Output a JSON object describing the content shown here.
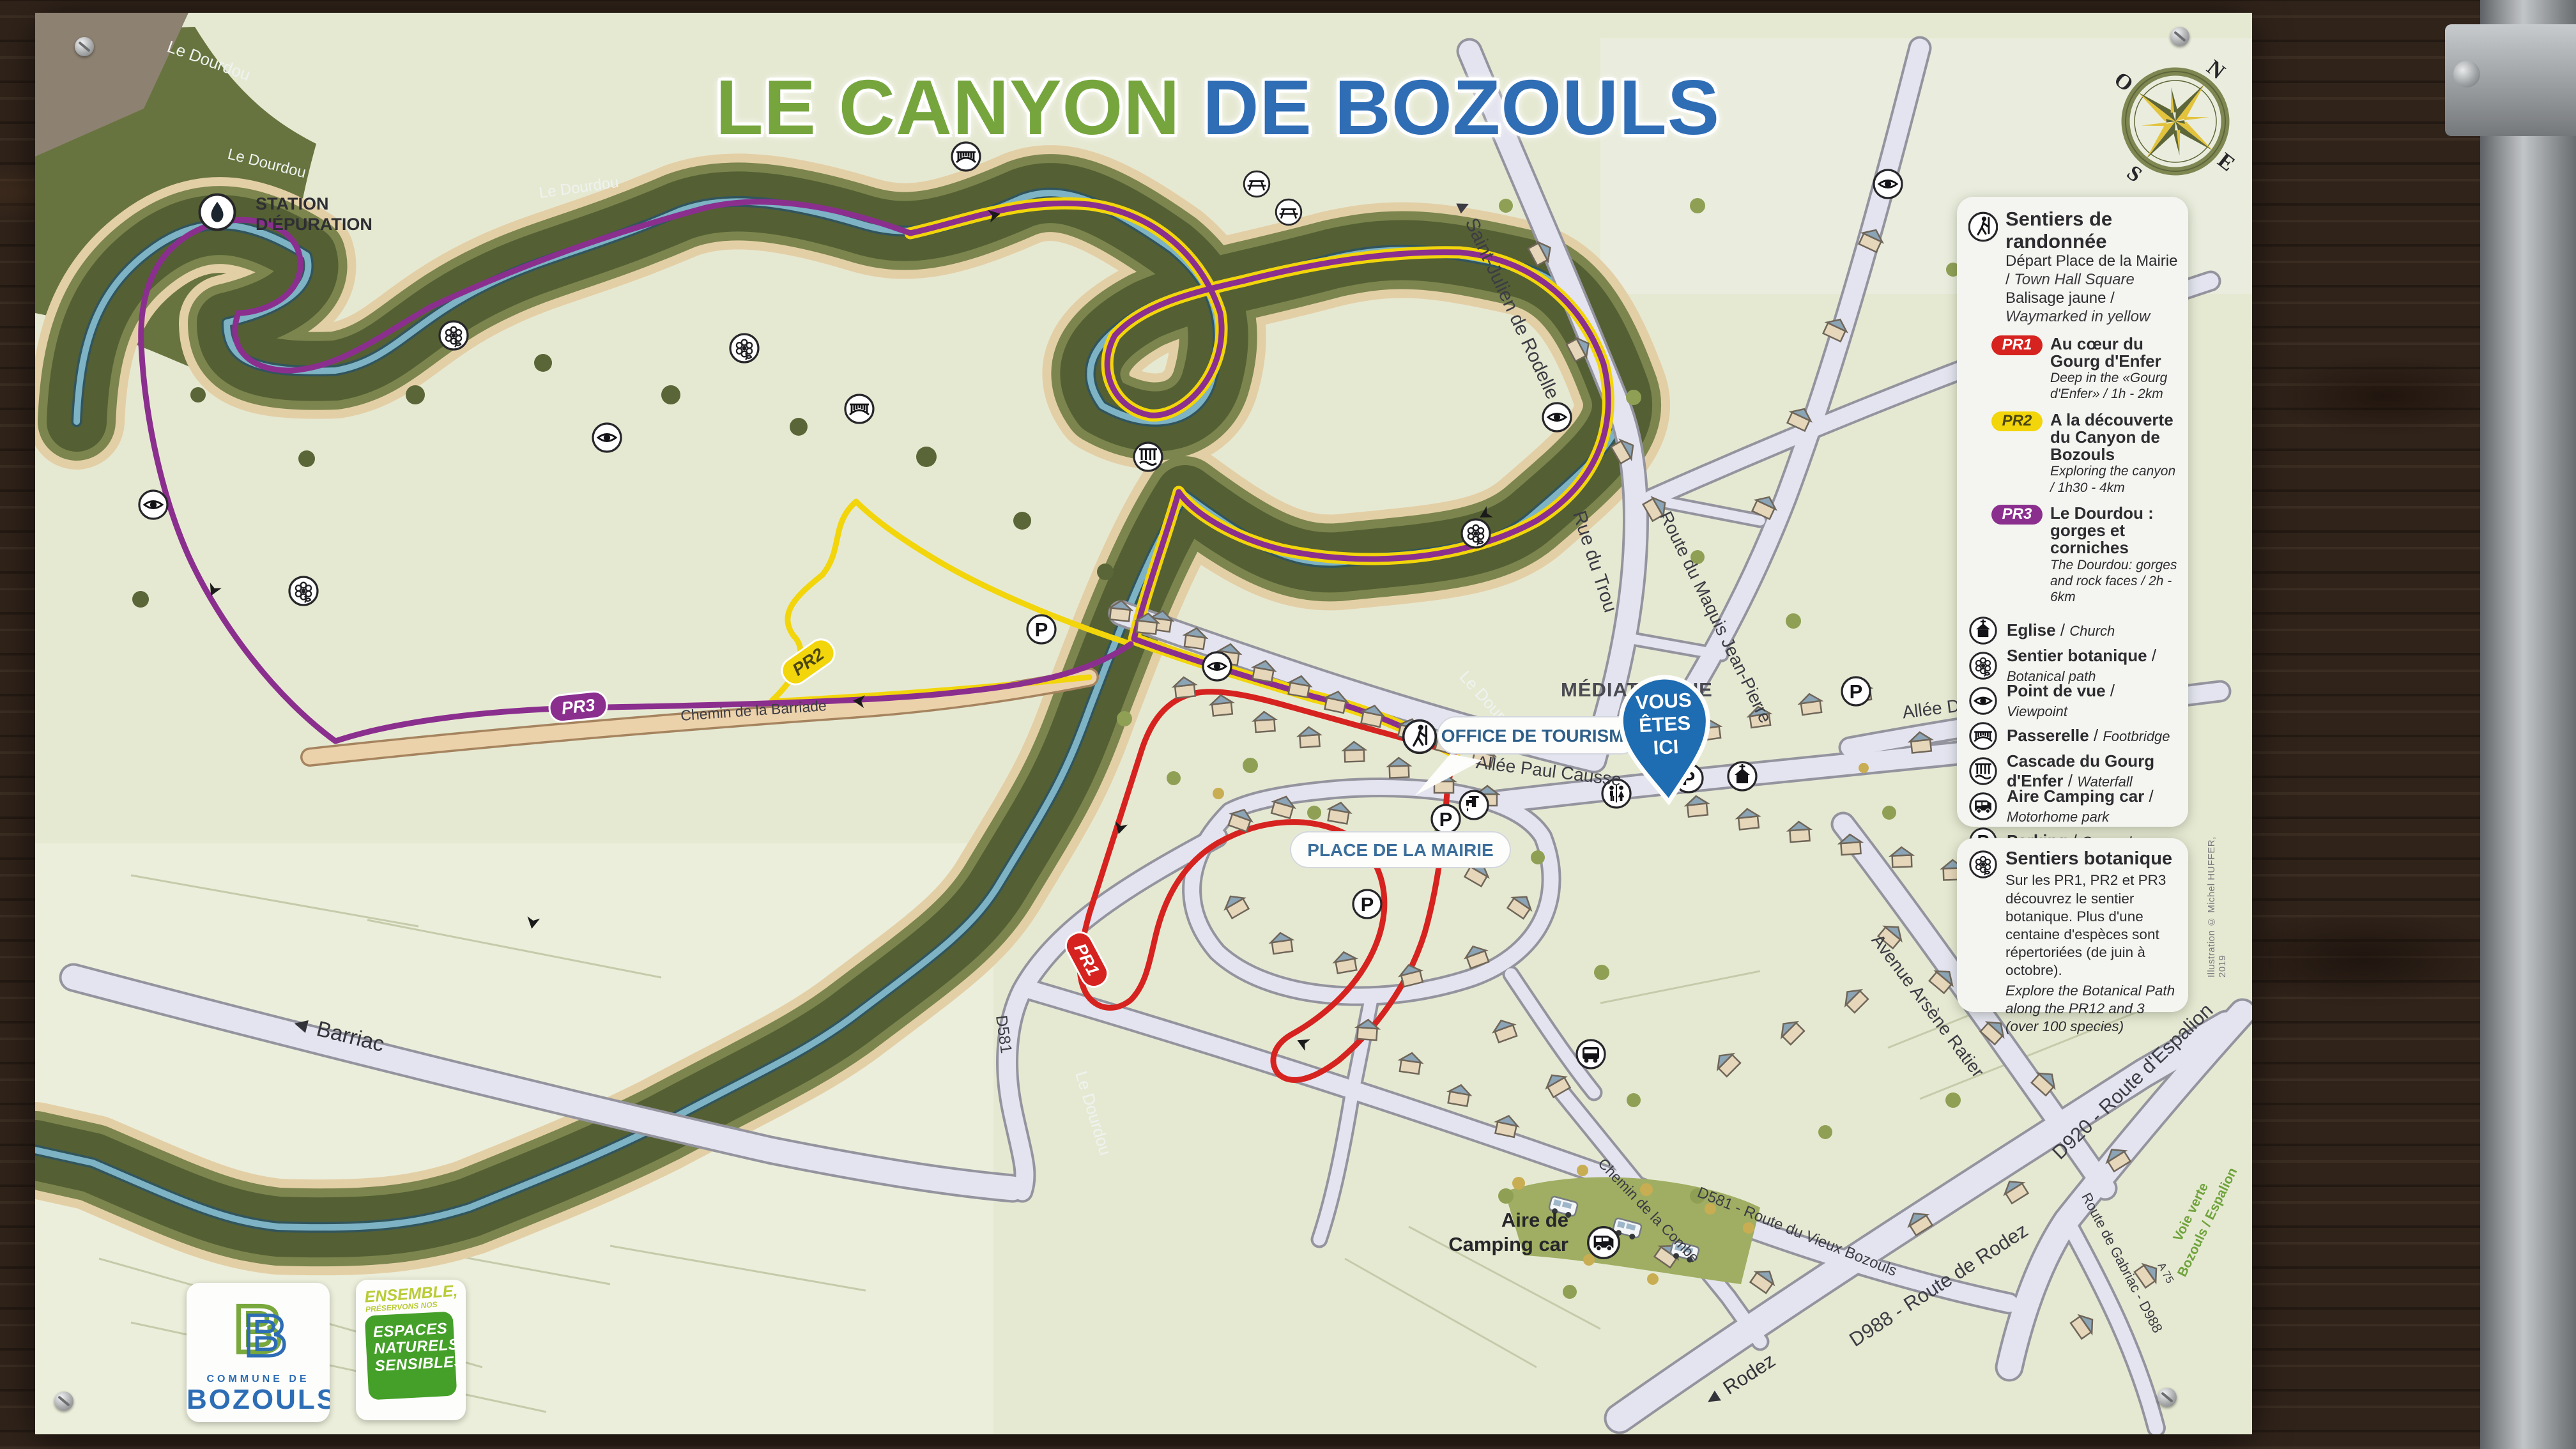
{
  "title": {
    "part1": "LE CANYON",
    "part2": " DE BOZOULS",
    "color1": "#76a53e",
    "color2": "#2f6db5"
  },
  "compass": {
    "n": "N",
    "e": "E",
    "s": "S",
    "o": "O"
  },
  "legend": {
    "header": {
      "title": "Sentiers de randonnée",
      "lines": [
        {
          "fr": "Départ Place de la Mairie",
          "en": "Town Hall Square"
        },
        {
          "fr": "Balisage jaune",
          "en": "Waymarked in yellow"
        }
      ]
    },
    "trails": [
      {
        "badge": "PR1",
        "color": "#d6231f",
        "text_color": "#ffffff",
        "fr": "Au cœur du Gourg d'Enfer",
        "en": "Deep in the «Gourg d'Enfer» / 1h - 2km"
      },
      {
        "badge": "PR2",
        "color": "#f2d50a",
        "text_color": "#4a4612",
        "fr": "A la découverte du Canyon de Bozouls",
        "en": "Exploring the canyon / 1h30 - 4km"
      },
      {
        "badge": "PR3",
        "color": "#8b2f8f",
        "text_color": "#ffffff",
        "fr": "Le Dourdou : gorges et corniches",
        "en": "The Dourdou: gorges and rock faces / 2h - 6km"
      }
    ],
    "items": [
      {
        "icon": "church-icon",
        "fr": "Eglise",
        "en": "Church"
      },
      {
        "icon": "botanical-path-icon",
        "fr": "Sentier botanique",
        "en": "Botanical path"
      },
      {
        "icon": "viewpoint-icon",
        "fr": "Point de vue",
        "en": "Viewpoint"
      },
      {
        "icon": "footbridge-icon",
        "fr": "Passerelle",
        "en": "Footbridge"
      },
      {
        "icon": "waterfall-icon",
        "fr": "Cascade du Gourg d'Enfer",
        "en": "Waterfall"
      },
      {
        "icon": "motorhome-icon",
        "fr": "Aire Camping car",
        "en": "Motorhome park"
      },
      {
        "icon": "parking-icon",
        "fr": "Parking",
        "en": "Car park"
      },
      {
        "icon": "picnic-icon",
        "fr": "Aire de Pique-nique",
        "en": "Picnic area"
      },
      {
        "icon": "toilets-icon",
        "fr": "Toilettes",
        "en": "WC"
      },
      {
        "icon": "bus-icon",
        "fr": "Bus",
        "en": "Bus"
      },
      {
        "icon": "water-point-icon",
        "fr": "Point d'eau",
        "en": "Water point"
      }
    ],
    "botanical": {
      "title": "Sentiers botanique",
      "fr": "Sur les PR1, PR2 et PR3 découvrez le sentier botanique. Plus d'une centaine d'espèces sont répertoriées (de juin à octobre).",
      "en": "Explore the Botanical Path along the PR12 and 3 (over 100 species)"
    },
    "credit": "Illustration © Michel HUFFER, 2019"
  },
  "map": {
    "labels": [
      {
        "text": "Le Dourdou"
      },
      {
        "text": "Le Dourdou"
      },
      {
        "text": "Le Dourdou"
      },
      {
        "text": "Le Dourdou"
      },
      {
        "text": "Le Dourdou"
      },
      {
        "text": "STATION"
      },
      {
        "text": "D'ÉPURATION"
      },
      {
        "text": "▲ Saint-Julien de Rodelle"
      },
      {
        "text": "Rue du Trou"
      },
      {
        "text": "Route du Maquis Jean-Pierre"
      },
      {
        "text": "Allée Paul Causse"
      },
      {
        "text": "Allée Denys-Puech"
      },
      {
        "text": "Avenue Arsène Ratier"
      },
      {
        "text": "Chemin de la Barriade"
      },
      {
        "text": "◄ Barriac"
      },
      {
        "text": "D581"
      },
      {
        "text": "Chemin de la Combe"
      },
      {
        "text": "D581 - Route du Vieux Bozouls"
      },
      {
        "text": "D988 - Route de Rodez"
      },
      {
        "text": "◄ Rodez"
      },
      {
        "text": "D920 - Route d'Espalion"
      },
      {
        "text": "Route de Gabriac - D988"
      },
      {
        "text": "Voie verte"
      },
      {
        "text": "Bozouls / Espalion"
      },
      {
        "text": "A 75"
      },
      {
        "text": "MÉDIATHÈQUE"
      },
      {
        "text": "Aire de"
      },
      {
        "text": "Camping car"
      }
    ],
    "bubbles": {
      "tourism": "OFFICE DE TOURISME",
      "mairie": "PLACE DE LA MAIRIE"
    },
    "badges": {
      "pr1": "PR1",
      "pr2": "PR2",
      "pr3": "PR3"
    },
    "pin": {
      "l1": "VOUS",
      "l2": "ÊTES",
      "l3": "ICI"
    }
  },
  "logos": {
    "commune": {
      "initial": "B",
      "line1": "COMMUNE DE",
      "line2": "BOZOULS"
    },
    "ens": {
      "top1": "ENSEMBLE,",
      "top2": "PRÉSERVONS NOS",
      "lines": [
        "ESPACES",
        "NATURELS",
        "SENSIBLES"
      ]
    }
  }
}
